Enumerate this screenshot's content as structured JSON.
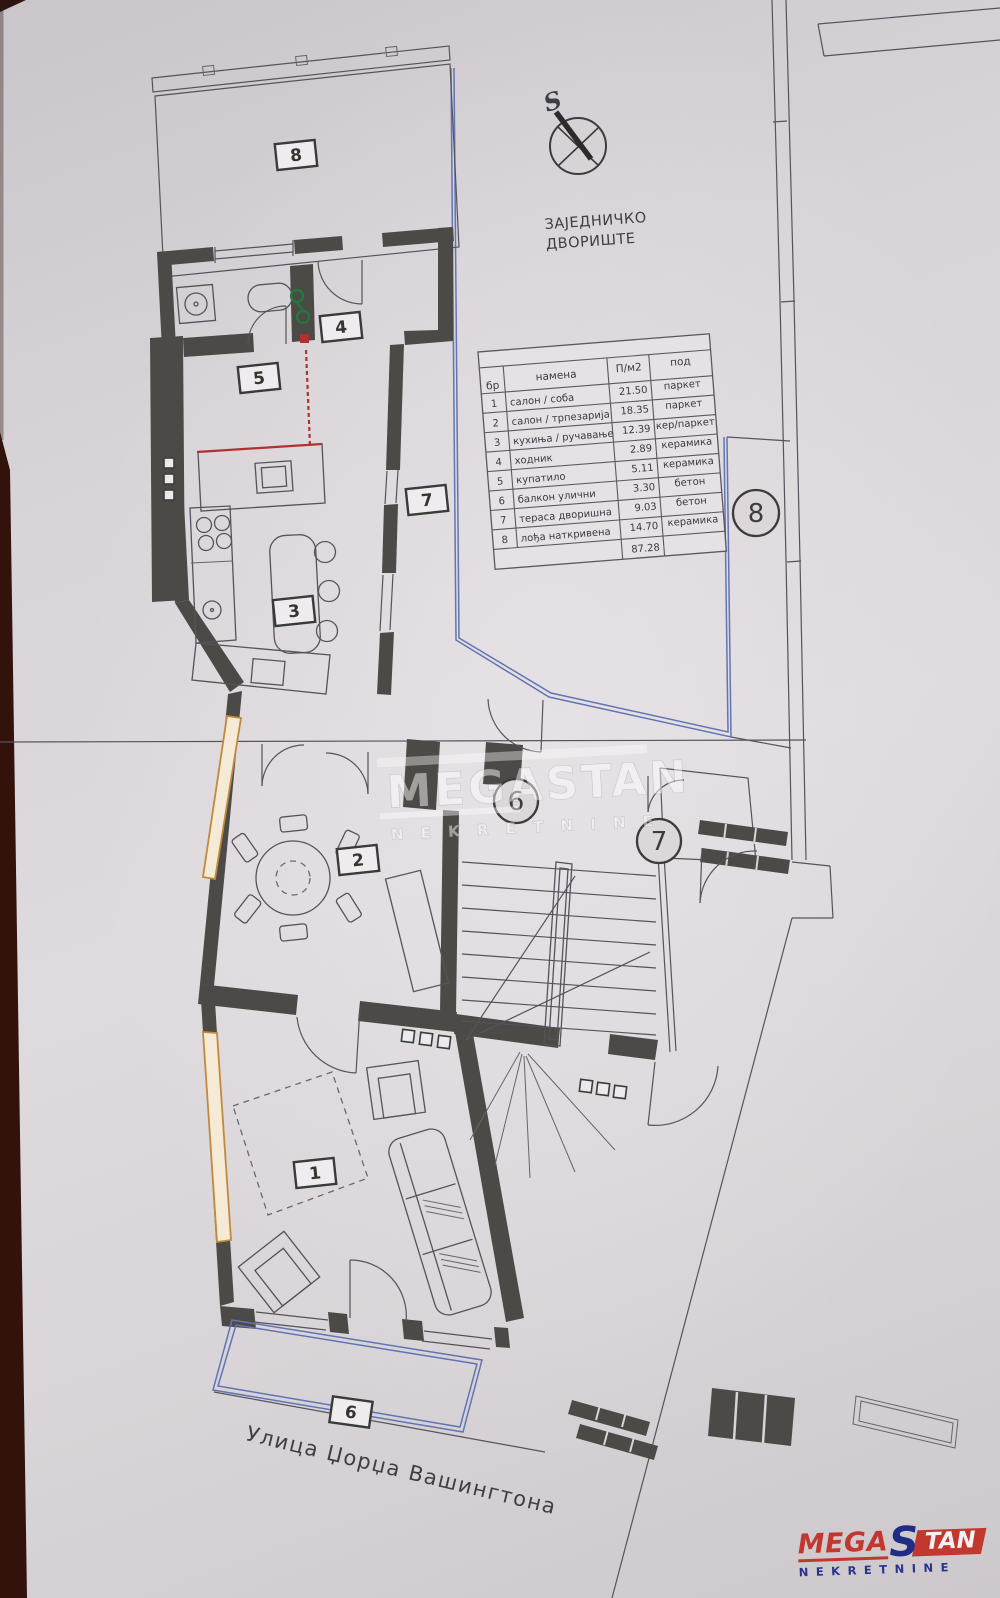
{
  "compass": {
    "label": "S"
  },
  "yard": {
    "label_line1": "ЗАЈЕДНИЧКО",
    "label_line2": "ДВОРИШТЕ"
  },
  "legend_table": {
    "headers": {
      "num": "бр",
      "purpose": "намена",
      "area": "П/м2",
      "floor": "под"
    },
    "rows": [
      {
        "num": "1",
        "purpose": "салон / соба",
        "area": "21.50",
        "floor": "паркет"
      },
      {
        "num": "2",
        "purpose": "салон / трпезарија",
        "area": "18.35",
        "floor": "паркет"
      },
      {
        "num": "3",
        "purpose": "кухиња / ручавање",
        "area": "12.39",
        "floor": "кер/паркет"
      },
      {
        "num": "4",
        "purpose": "ходник",
        "area": "2.89",
        "floor": "керамика"
      },
      {
        "num": "5",
        "purpose": "купатило",
        "area": "5.11",
        "floor": "керамика"
      },
      {
        "num": "6",
        "purpose": "балкон улични",
        "area": "3.30",
        "floor": "бетон"
      },
      {
        "num": "7",
        "purpose": "тераса дворишна",
        "area": "9.03",
        "floor": "бетон"
      },
      {
        "num": "8",
        "purpose": "лођа наткривена",
        "area": "14.70",
        "floor": "керамика"
      }
    ],
    "total_area": "87.28"
  },
  "room_labels": {
    "r1": "1",
    "r2": "2",
    "r3": "3",
    "r4": "4",
    "r5": "5",
    "r6": "6",
    "r7": "7",
    "r8": "8"
  },
  "circled_labels": {
    "c6": "6",
    "c7": "7",
    "c8": "8"
  },
  "street": {
    "name": "Улица Џорџа Вашингтона"
  },
  "watermark": {
    "brand": "MEGASTAN",
    "sub": "N E K R E T N I N E"
  },
  "logo": {
    "mega": "MEGA",
    "s": "S",
    "tan": "TAN",
    "sub": "NEKRETNINE"
  },
  "colors": {
    "wall": "#4c4a47",
    "boundary_blue": "#6274b4",
    "accent_red": "#b23030",
    "accent_green": "#1f7a3c",
    "accent_orange": "#c08a3e",
    "logo_red": "#c2372e",
    "logo_blue": "#27338f"
  }
}
